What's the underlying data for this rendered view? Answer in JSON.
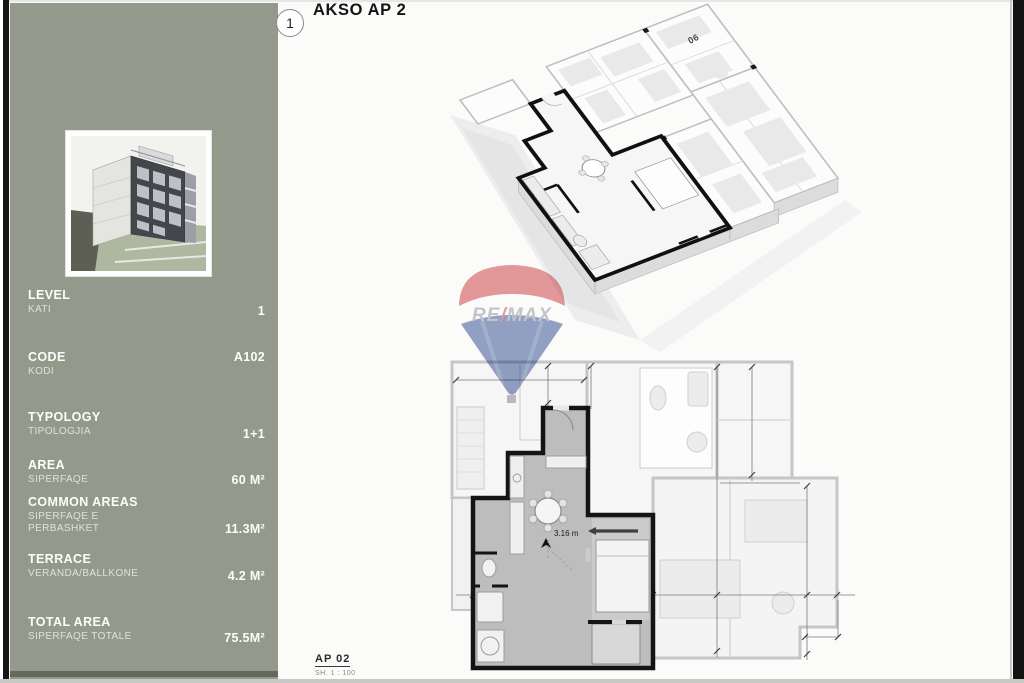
{
  "header": {
    "badge": "1",
    "title": "AKSO AP 2"
  },
  "sidebar": {
    "thumbnail": "building-3d-render",
    "specs": [
      {
        "label": "LEVEL",
        "sublabel": "KATI",
        "value": "1"
      },
      {
        "label": "CODE",
        "sublabel": "KODI",
        "value": "A102"
      },
      {
        "label": "TYPOLOGY",
        "sublabel": "TIPOLOGJIA",
        "value": "1+1"
      },
      {
        "label": "AREA",
        "sublabel": "SIPERFAQE",
        "value": "60 M²"
      },
      {
        "label": "COMMON AREAS",
        "sublabel": "SIPERFAQE E PERBASHKET",
        "value": "11.3M²"
      },
      {
        "label": "TERRACE",
        "sublabel": "VERANDA/BALLKONE",
        "value": "4.2 M²"
      },
      {
        "label": "TOTAL AREA",
        "sublabel": "SIPERFAQE TOTALE",
        "value": "75.5M²"
      }
    ]
  },
  "axon": {
    "unit_label": "06"
  },
  "plan": {
    "dimension_label": "3.16 m",
    "sheet_code": "AP 02",
    "sheet_scale": "SH. 1 : 100"
  },
  "watermark": {
    "brand": "RE/MAX",
    "part_re": "RE",
    "part_slash": "/",
    "part_max": "MAX"
  },
  "colors": {
    "sidebar_panel": "#939a8c",
    "sidebar_accent_dark": "#646a5a",
    "apartment_wall": "#141414",
    "neighbor_wall": "#c6c6c6",
    "apartment_fill": "#bdbdbd",
    "remax_red": "#cf3a40",
    "remax_blue": "#2f4e92",
    "page_background": "#fbfbfa"
  }
}
